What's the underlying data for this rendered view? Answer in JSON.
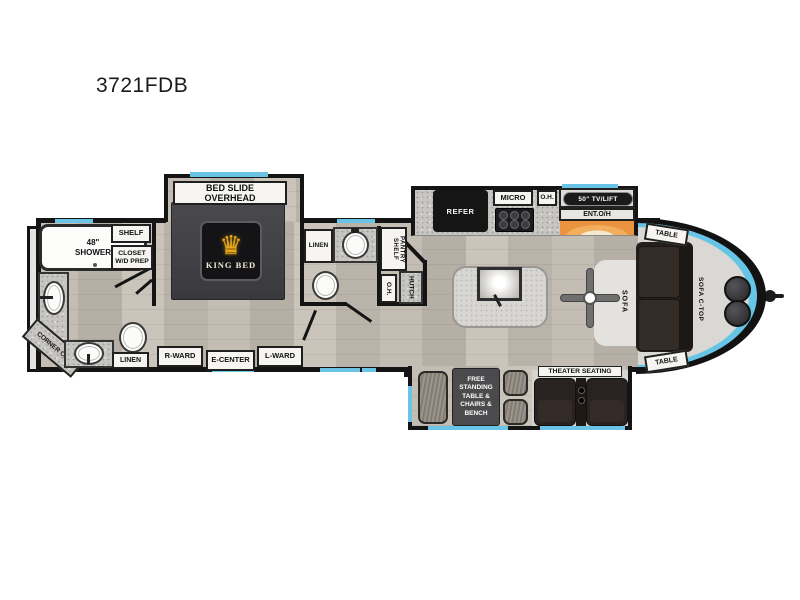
{
  "title": "3721FDB",
  "colors": {
    "accent_blue": "#6ac4e6",
    "accent_orange": "#ef9a41",
    "wall": "#141414",
    "crown_gold": "#e8a81c",
    "floor": "#beb8ae"
  },
  "rooms": {
    "front_bath": {
      "shower": "48\" SHOWER",
      "shelf": "SHELF",
      "closet": "CLOSET W/D PREP",
      "corner_cab": "CORNER CAB",
      "linen": "LINEN"
    },
    "bedroom": {
      "bed_slide": "BED SLIDE OVERHEAD",
      "king_bed": "KING BED",
      "crown_icon": "♛",
      "r_ward": "R-WARD",
      "e_center": "E-CENTER",
      "l_ward": "L-WARD"
    },
    "mid_bath": {
      "linen": "LINEN",
      "pantry_shelf": "PANTRY SHELF",
      "overhead": "O.H.",
      "hutch": "HUTCH"
    },
    "kitchen": {
      "refer": "REFER",
      "micro": "MICRO",
      "overhead": "O.H.",
      "tv": "50\" TV/LIFT",
      "ent_oh": "ENT.O/H"
    },
    "living": {
      "table_front": "TABLE",
      "sofa": "SOFA",
      "sofa_ctop": "SOFA C-TOP",
      "table_rear": "TABLE",
      "theater": "THEATER SEATING",
      "dinette": "FREE STANDING TABLE & CHAIRS & BENCH"
    }
  }
}
